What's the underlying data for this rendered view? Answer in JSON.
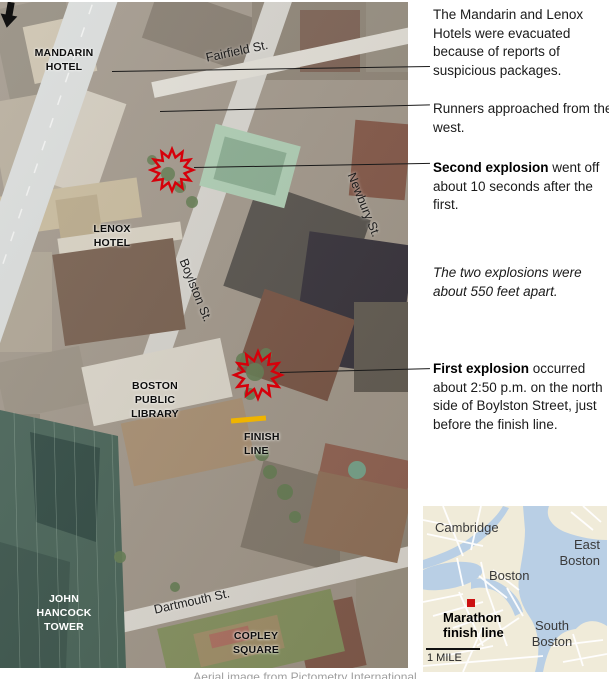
{
  "annotations": {
    "evacuation": {
      "text": "The Mandarin and Lenox Hotels were evacuated because of reports of suspicious packages."
    },
    "runners": {
      "text": "Runners approached from the west."
    },
    "second_explosion": {
      "lead": "Second explosion",
      "rest": " went off about 10 seconds after the first."
    },
    "distance_note": {
      "text": "The two explosions were about 550 feet apart."
    },
    "first_explosion": {
      "lead": "First explosion",
      "rest": " occurred about 2:50 p.m. on the north side of Boylston Street, just before the finish line."
    }
  },
  "map_labels": {
    "mandarin_hotel": "MANDARIN\nHOTEL",
    "lenox_hotel": "LENOX\nHOTEL",
    "boston_public_library": "BOSTON\nPUBLIC\nLIBRARY",
    "john_hancock_tower": "JOHN\nHANCOCK\nTOWER",
    "copley_square": "COPLEY\nSQUARE",
    "finish_line": "FINISH\nLINE"
  },
  "streets": {
    "fairfield": "Fairfield St.",
    "newbury": "Newbury St.",
    "boylston": "Boylston St.",
    "dartmouth": "Dartmouth St."
  },
  "inset_map": {
    "cambridge": "Cambridge",
    "east_boston": "East\nBoston",
    "boston": "Boston",
    "south_boston": "South\nBoston",
    "marker_label": "Marathon\nfinish line",
    "scale_label": "1 MILE"
  },
  "credit": "Aerial image from Pictometry International",
  "colors": {
    "explosion_red": "#d6000a",
    "finish_line_yellow": "#f0b400",
    "marker_red": "#cc1111",
    "inset_water": "#b9cfe5",
    "inset_land": "#f0ebd9",
    "leader_line": "#1a1a1a"
  }
}
